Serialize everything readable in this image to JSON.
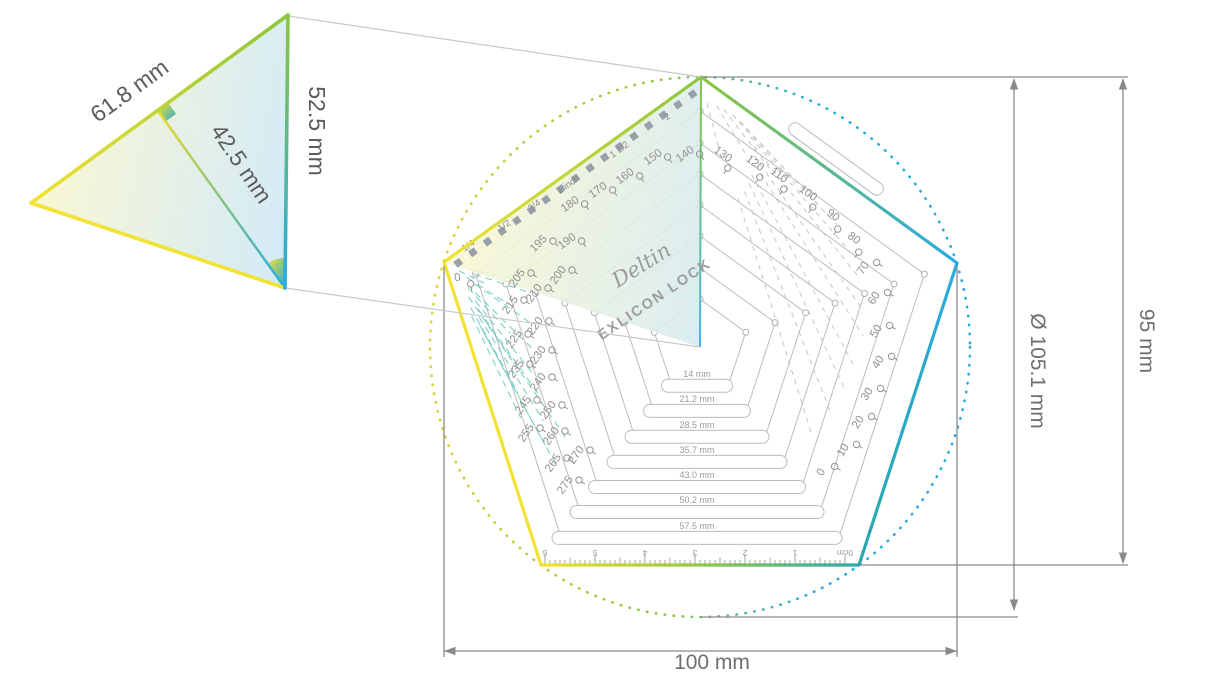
{
  "detail_triangle": {
    "side_label": "61.8 mm",
    "apothem_label": "42.5 mm",
    "radius_label": "52.5 mm"
  },
  "dimensions": {
    "width_label": "100 mm",
    "diameter_label": "Ø 105.1 mm",
    "height_label": "95 mm"
  },
  "brand": {
    "logo": "Deltin",
    "product": "EXLICON LOCK"
  },
  "inch_scale": [
    {
      "label": "1/4",
      "x": 470,
      "y": 248,
      "rot": -36
    },
    {
      "label": "1/2",
      "x": 506,
      "y": 228,
      "rot": -36
    },
    {
      "label": "3/4",
      "x": 536,
      "y": 208,
      "rot": -36
    },
    {
      "label": "1 inch",
      "x": 570,
      "y": 187,
      "rot": -36
    },
    {
      "label": "1 1/2",
      "x": 621,
      "y": 152,
      "rot": -36
    },
    {
      "label": "2",
      "x": 669,
      "y": 119,
      "rot": -36
    }
  ],
  "cm_scale": [
    "6",
    "5",
    "4",
    "3",
    "2",
    "1",
    "0cm"
  ],
  "slots": [
    {
      "label": "14 mm",
      "w": 71,
      "r": 48
    },
    {
      "label": "21.2 mm",
      "w": 107,
      "r": 79
    },
    {
      "label": "28.5 mm",
      "w": 144,
      "r": 111
    },
    {
      "label": "35.7 mm",
      "w": 180,
      "r": 142
    },
    {
      "label": "43.0 mm",
      "w": 217,
      "r": 173
    },
    {
      "label": "50.2 mm",
      "w": 254,
      "r": 204
    },
    {
      "label": "57.5 mm",
      "w": 290,
      "r": 236
    }
  ],
  "mm_scale": {
    "edge_row": [
      {
        "v": "180",
        "x": 572,
        "y": 207,
        "rot": -36
      },
      {
        "v": "170",
        "x": 600,
        "y": 193,
        "rot": -36
      },
      {
        "v": "160",
        "x": 627,
        "y": 179,
        "rot": -36
      },
      {
        "v": "150",
        "x": 655,
        "y": 160,
        "rot": -36
      },
      {
        "v": "140",
        "x": 687,
        "y": 157,
        "rot": -36
      }
    ],
    "right": [
      {
        "v": "130",
        "x": 721,
        "y": 157,
        "rot": 36
      },
      {
        "v": "120",
        "x": 753,
        "y": 166,
        "rot": 36
      },
      {
        "v": "110",
        "x": 777,
        "y": 178,
        "rot": 36
      },
      {
        "v": "100",
        "x": 806,
        "y": 196,
        "rot": 36
      },
      {
        "v": "90",
        "x": 831,
        "y": 218,
        "rot": 36
      },
      {
        "v": "80",
        "x": 852,
        "y": 241,
        "rot": 36
      },
      {
        "v": "70",
        "x": 866,
        "y": 270,
        "rot": -58
      },
      {
        "v": "60",
        "x": 877,
        "y": 300,
        "rot": -58
      },
      {
        "v": "50",
        "x": 879,
        "y": 333,
        "rot": -58
      },
      {
        "v": "40",
        "x": 881,
        "y": 364,
        "rot": -58
      },
      {
        "v": "30",
        "x": 870,
        "y": 396,
        "rot": -58
      },
      {
        "v": "20",
        "x": 861,
        "y": 424,
        "rot": -58
      },
      {
        "v": "10",
        "x": 846,
        "y": 452,
        "rot": -58
      },
      {
        "v": "0",
        "x": 824,
        "y": 474,
        "rot": -58
      }
    ],
    "left": [
      {
        "v": "195",
        "x": 541,
        "y": 246,
        "rot": -45
      },
      {
        "v": "190",
        "x": 569,
        "y": 244,
        "rot": -36
      },
      {
        "v": "200",
        "x": 561,
        "y": 277,
        "rot": -55
      },
      {
        "v": "205",
        "x": 520,
        "y": 280,
        "rot": -55
      },
      {
        "v": "210",
        "x": 537,
        "y": 295,
        "rot": -55
      },
      {
        "v": "215",
        "x": 513,
        "y": 307,
        "rot": -55
      },
      {
        "v": "220",
        "x": 538,
        "y": 328,
        "rot": -55
      },
      {
        "v": "225",
        "x": 517,
        "y": 341,
        "rot": -55
      },
      {
        "v": "230",
        "x": 541,
        "y": 357,
        "rot": -55
      },
      {
        "v": "235",
        "x": 519,
        "y": 371,
        "rot": -55
      },
      {
        "v": "240",
        "x": 541,
        "y": 384,
        "rot": -55
      },
      {
        "v": "245",
        "x": 526,
        "y": 407,
        "rot": -55
      },
      {
        "v": "250",
        "x": 551,
        "y": 412,
        "rot": -55
      },
      {
        "v": "255",
        "x": 529,
        "y": 435,
        "rot": -55
      },
      {
        "v": "260",
        "x": 554,
        "y": 438,
        "rot": -55
      },
      {
        "v": "265",
        "x": 556,
        "y": 465,
        "rot": -55
      },
      {
        "v": "270",
        "x": 579,
        "y": 457,
        "rot": -55
      },
      {
        "v": "275",
        "x": 568,
        "y": 487,
        "rot": -55
      }
    ],
    "origin": [
      {
        "v": "0",
        "x": 458,
        "y": 281,
        "rot": -10
      }
    ]
  },
  "colors": {
    "yellow": "#f2e232",
    "green": "#8cc63e",
    "blue": "#29abe2",
    "teal": "#2ba8a8",
    "teal_dash": "#74ccc1",
    "gray_dash": "#c5c5c5",
    "line_gray": "#8a8a8a",
    "thin_gray": "#bcbcbc",
    "tick_square": "#98a1a9",
    "scale_text": "#919191"
  }
}
